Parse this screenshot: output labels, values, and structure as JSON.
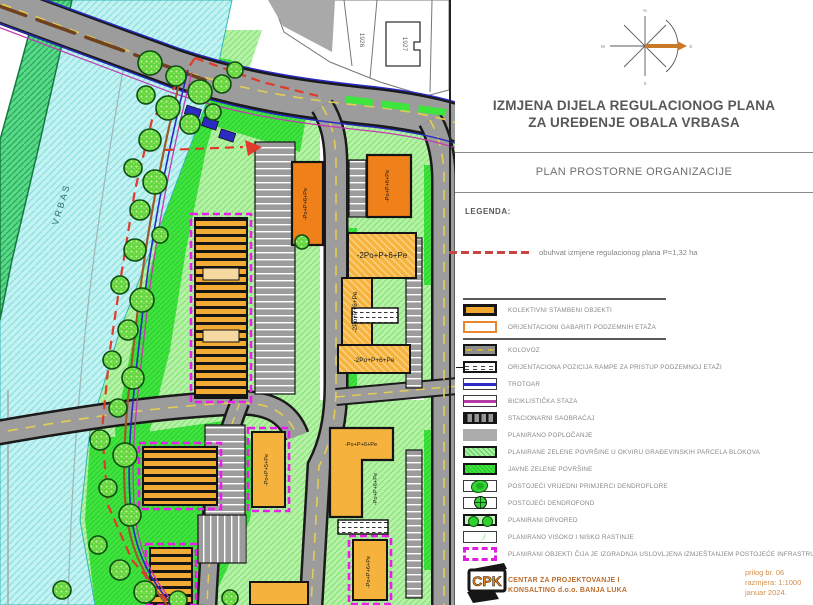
{
  "panel": {
    "title_line1": "IZMJENA DIJELA REGULACIONOG PLANA",
    "title_line2": "ZA UREĐENJE OBALA VRBASA",
    "subtitle": "PLAN PROSTORNE ORGANIZACIJE",
    "legend_heading": "LEGENDA:",
    "scope_note": "obuhvat izmjene regulacionog plana P=1,32 ha",
    "compass": {
      "north": "N",
      "east": "E",
      "south": "S",
      "west": "W"
    },
    "legend_items": [
      {
        "id": "kolektivni",
        "label": "KOLEKTIVNI STAMBENI OBJEKTI"
      },
      {
        "id": "gabarit",
        "label": "ORIJENTACIONI GABARITI PODZEMNIH ETAŽA"
      },
      {
        "id": "kolovoz",
        "label": "KOLOVOZ"
      },
      {
        "id": "rampa",
        "label": "ORIJENTACIONA POZICIJA RAMPE ZA PRISTUP PODZEMNOJ ETAŽI"
      },
      {
        "id": "trotoar",
        "label": "TROTOAR"
      },
      {
        "id": "biciklisticka",
        "label": "BICIKLISTIČKA STAZA"
      },
      {
        "id": "stacionarni",
        "label": "STACIONARNI SAOBRAĆAJ"
      },
      {
        "id": "poplocanje",
        "label": "PLANIRANO POPLOČANJE"
      },
      {
        "id": "zelene-parcele",
        "label": "PLANIRANE ZELENE POVRŠINE U OKVIRU GRAĐEVINSKIH PARCELA BLOKOVA"
      },
      {
        "id": "javne-zelene",
        "label": "JAVNE ZELENE POVRŠINE"
      },
      {
        "id": "dendroflora",
        "label": "POSTOJEĆI VRIJEDNI PRIMJERCI DENDROFLORE"
      },
      {
        "id": "dendrofond",
        "label": "POSTOJEĆI DENDROFOND"
      },
      {
        "id": "drvored",
        "label": "PLANIRANI DRVORED"
      },
      {
        "id": "rastinje",
        "label": "PLANIRANO VISOKO I NISKO RASTINJE"
      },
      {
        "id": "uslovljeni",
        "label": "PLANIRANI OBJEKTI ČIJA JE IZGRADNJA USLOVLJENA IZMJEŠTANJEM POSTOJEĆE INFRASTRUKTURE"
      }
    ],
    "footer": {
      "logo_text": "CPK",
      "company_line1": "CENTAR ZA PROJEKTOVANJE I",
      "company_line2": "KONSALTING d.o.o. BANJA LUKA",
      "attachment_no": "prilog br. 06",
      "scale": "razmjera:  1:1000",
      "date": "januar 2024."
    }
  },
  "map": {
    "river_label": "VRBAS",
    "parcel_labels": [
      "1926",
      "1927"
    ],
    "building_labels": [
      "-Po+P+6+Pe",
      "-Po+P+6+Pe",
      "-2Po+P+6+Pe",
      "-2Po+P+6+Pe",
      "-2Po+P+6+Pe",
      "-Po+P+5+Pe",
      "-Po+P+6+Pe",
      "-Po+P+6+Pe",
      "-Po+P+6+Pe"
    ]
  },
  "colors": {
    "building_orange": "#f08019",
    "building_golden": "#f5b23c",
    "scope_red": "#d44040",
    "planned_magenta": "#e91fe9",
    "public_green": "#3fe53f",
    "river_cyan": "#c2f2f2",
    "road_gray": "#9c9c9c",
    "logo_orange": "#e8831e"
  }
}
